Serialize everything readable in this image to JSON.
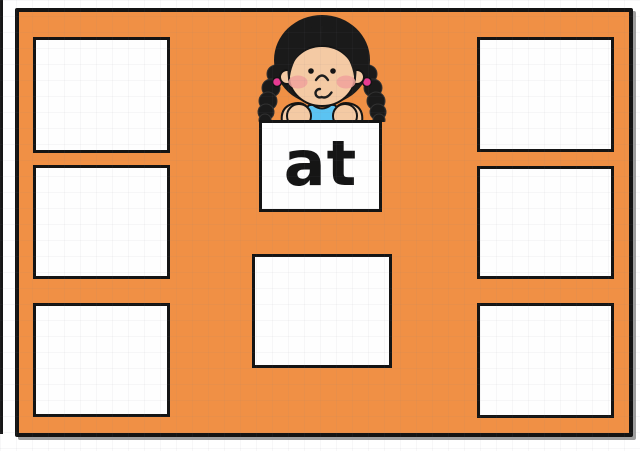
{
  "scene": {
    "description": "word family sorting activity board",
    "word_card": {
      "label": "at"
    },
    "character": {
      "name": "girl-with-braids"
    },
    "drop_zones": [
      {
        "id": "left-top",
        "label": ""
      },
      {
        "id": "left-middle",
        "label": ""
      },
      {
        "id": "left-bottom",
        "label": ""
      },
      {
        "id": "right-top",
        "label": ""
      },
      {
        "id": "right-middle",
        "label": ""
      },
      {
        "id": "right-bottom",
        "label": ""
      },
      {
        "id": "center-bottom",
        "label": ""
      }
    ],
    "colors": {
      "board_orange": "#f09045",
      "outline_black": "#141414",
      "hair_black": "#1a1a1a",
      "skin": "#f4caa4",
      "blush": "#f0a29c",
      "shirt_blue": "#5bc3f2",
      "shirt_trim_blue": "#2a9ad6",
      "hair_tie_pink": "#e93a92",
      "card_white": "#fefefe"
    }
  }
}
